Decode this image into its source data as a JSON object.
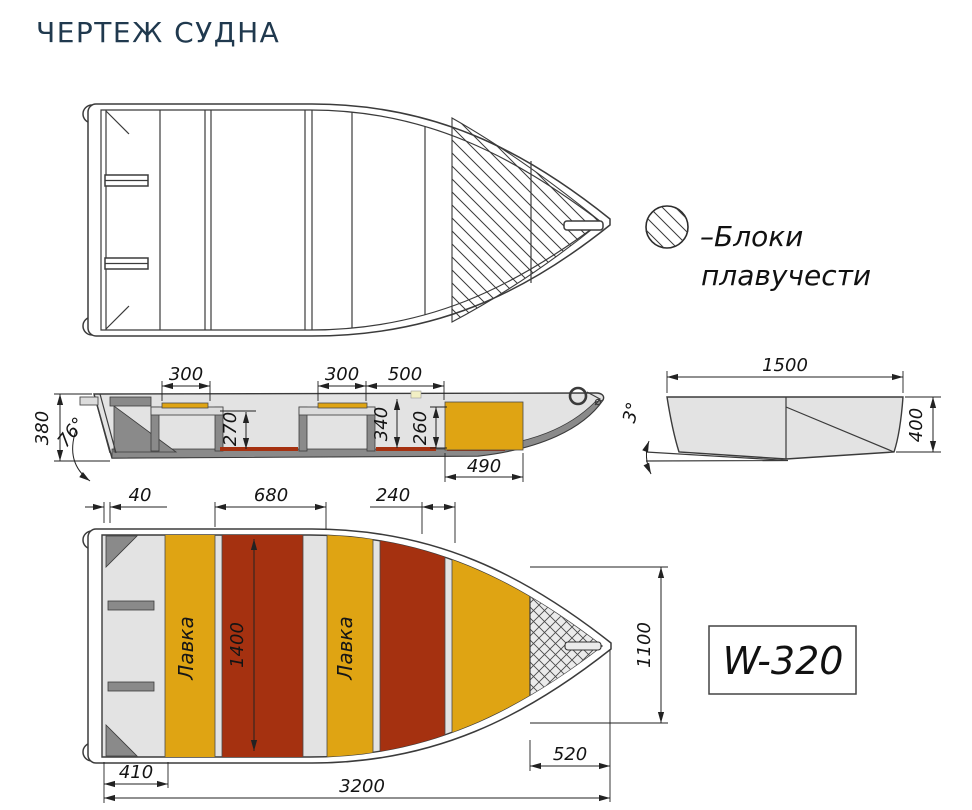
{
  "title": "ЧЕРТЕЖ СУДНА",
  "legend": {
    "line1": "–Блоки",
    "line2": "плавучести"
  },
  "model_badge": "W-320",
  "colors": {
    "title": "#20394E",
    "seat_yellow": "#DFA413",
    "floor_red": "#A53110",
    "hull_light": "#E3E3E3",
    "hull_mid": "#8A8A8A",
    "line": "#3B3B3B"
  },
  "side_view": {
    "dims": {
      "seat_front": "300",
      "seat_rear": "300",
      "bay_length": "500",
      "transom_height": "380",
      "transom_angle": "76°",
      "seat_clearance": "270",
      "bay_depth": "340",
      "block_height": "260",
      "block_length": "490"
    }
  },
  "section_view": {
    "dims": {
      "beam": "1500",
      "bottom_angle": "3°",
      "side_height": "400"
    }
  },
  "plan_view": {
    "bench_label": "Лавка",
    "dims": {
      "transom_thickness": "40",
      "cockpit_section": "680",
      "bow_seat": "240",
      "cockpit_width": "1400",
      "bow_width": "1100",
      "bow_length": "520",
      "stern_section": "410",
      "overall_length": "3200"
    }
  }
}
